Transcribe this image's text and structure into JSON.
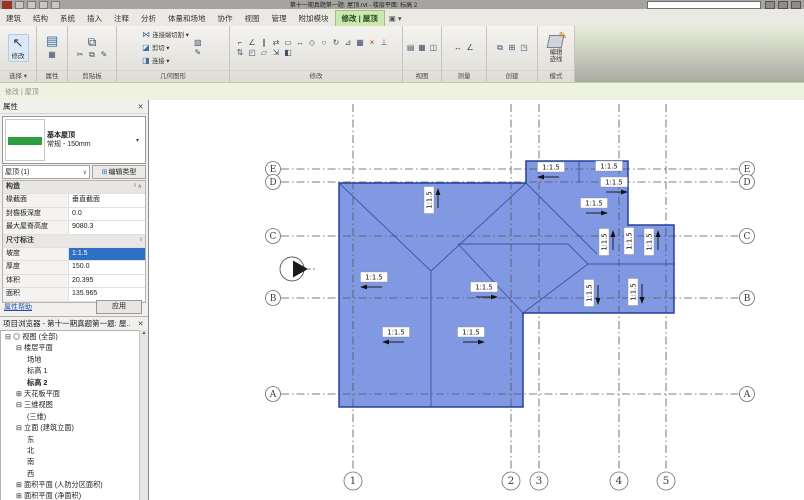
{
  "title_bar": {
    "app_title": "第十一期真题第一题: 屋顶.rvt - 楼层平面: 标高 2"
  },
  "tabs": {
    "items": [
      "建筑",
      "结构",
      "系统",
      "插入",
      "注释",
      "分析",
      "体量和场地",
      "协作",
      "视图",
      "管理",
      "附加模块"
    ],
    "contextual": "修改 | 屋顶",
    "expander": "▣ ▾"
  },
  "ribbon": {
    "modify_button": "修改",
    "select_label": "选择 ▾",
    "properties_label": "属性",
    "clipboard_label": "剪贴板",
    "geometry_label": "几何图形",
    "geometry_items": [
      "连接端切割 ▾",
      "剪切 ▾",
      "连接 ▾"
    ],
    "geometry_icons": [
      "⋈",
      "◪",
      "◨"
    ],
    "modify_panel_label": "修改",
    "modify_icons": [
      "⌐",
      "∠",
      "∥",
      "⇄",
      "▭",
      "↔",
      "◇",
      "○",
      "↻",
      "⊿",
      "▦",
      "×",
      "⊥",
      "⇅",
      "◰",
      "▱",
      "⇲",
      "◧"
    ],
    "view_label": "视图",
    "view_icons": [
      "▤",
      "▦",
      "◫"
    ],
    "measure_label": "测量",
    "measure_icons": [
      "↔",
      "∠"
    ],
    "create_label": "创建",
    "create_icons": [
      "⧉",
      "⊞",
      "◳"
    ],
    "mode_label": "模式",
    "edit_footprint_line1": "编辑",
    "edit_footprint_line2": "迹线",
    "cursor_icon": "↖",
    "palette_icon": "▤",
    "paste_icon": "⧉",
    "clipboard_icons": [
      "✂",
      "⧉",
      "✎"
    ]
  },
  "options_bar": {
    "label": "修改 | 屋顶"
  },
  "properties": {
    "title": "属性",
    "close": "✕",
    "type_name": "基本屋顶",
    "type_desc": "常规 - 150mm",
    "type_arrow": "▾",
    "filter": "屋顶 (1)",
    "filter_arrow": "∨",
    "edit_type": "编辑类型",
    "edit_type_icon": "⊞",
    "sections": [
      {
        "header": "构造",
        "mark": "² ∧",
        "rows": [
          [
            "椽截面",
            "垂直截面"
          ],
          [
            "封檐板深度",
            "0.0"
          ],
          [
            "最大屋脊高度",
            "9080.3"
          ]
        ]
      },
      {
        "header": "尺寸标注",
        "mark": "²",
        "rows": [
          [
            "坡度",
            "1:1.5"
          ],
          [
            "厚度",
            "150.0"
          ],
          [
            "体积",
            "20.395"
          ],
          [
            "面积",
            "135.965"
          ]
        ]
      }
    ],
    "selected": {
      "section": 1,
      "row": 0
    },
    "help": "属性帮助",
    "apply": "应用"
  },
  "browser": {
    "title": "项目浏览器 - 第十一期真题第一题: 屋..",
    "close": "✕",
    "scroll_up": "▲",
    "items": [
      {
        "t": "⊟ ◎ 视图 (全部)",
        "lv": 0
      },
      {
        "t": "⊟ 楼层平面",
        "lv": 1
      },
      {
        "t": "场地",
        "lv": 2
      },
      {
        "t": "标高 1",
        "lv": 2
      },
      {
        "t": "标高 2",
        "lv": 2,
        "bold": true
      },
      {
        "t": "⊞ 天花板平面",
        "lv": 1
      },
      {
        "t": "⊟ 三维视图",
        "lv": 1
      },
      {
        "t": "(三维)",
        "lv": 2
      },
      {
        "t": "⊟ 立面 (建筑立面)",
        "lv": 1
      },
      {
        "t": "东",
        "lv": 2
      },
      {
        "t": "北",
        "lv": 2
      },
      {
        "t": "南",
        "lv": 2
      },
      {
        "t": "西",
        "lv": 2
      },
      {
        "t": "⊞ 面积平面 (人防分区面积)",
        "lv": 1
      },
      {
        "t": "⊞ 面积平面 (净面积)",
        "lv": 1
      }
    ]
  },
  "plan": {
    "grid_rows": [
      {
        "label": "E",
        "y": 169
      },
      {
        "label": "D",
        "y": 182
      },
      {
        "label": "C",
        "y": 236
      },
      {
        "label": "B",
        "y": 298
      },
      {
        "label": "A",
        "y": 394
      }
    ],
    "grid_cols": [
      {
        "label": "1",
        "x": 352
      },
      {
        "label": "2",
        "x": 510
      },
      {
        "label": "3",
        "x": 538
      },
      {
        "label": "4",
        "x": 618
      },
      {
        "label": "5",
        "x": 665
      }
    ],
    "row_bubble": {
      "left_cx": 272,
      "right_cx": 746,
      "r": 7.5,
      "line_x1": 280,
      "line_x2": 738
    },
    "col_bubble": {
      "cy": 481,
      "r": 9,
      "line_y1": 104,
      "line_y2": 470
    },
    "roof_outline": [
      [
        338,
        183
      ],
      [
        525,
        183
      ],
      [
        525,
        161
      ],
      [
        627,
        161
      ],
      [
        627,
        225
      ],
      [
        673,
        225
      ],
      [
        673,
        313
      ],
      [
        522,
        313
      ],
      [
        522,
        407
      ],
      [
        338,
        407
      ]
    ],
    "roof_lines": [
      [
        338,
        183,
        430,
        271
      ],
      [
        430,
        271,
        430,
        407
      ],
      [
        430,
        271,
        525,
        183
      ],
      [
        525,
        183,
        596,
        254
      ],
      [
        457,
        244,
        567,
        244
      ],
      [
        567,
        244,
        587,
        264
      ],
      [
        587,
        264,
        673,
        264
      ],
      [
        457,
        244,
        522,
        313
      ],
      [
        522,
        313,
        587,
        264
      ],
      [
        578,
        161,
        578,
        183
      ]
    ],
    "slope_labels": [
      {
        "x": 550,
        "y": 167,
        "rot": 0,
        "arrow": "left",
        "text": "1:1.5"
      },
      {
        "x": 608,
        "y": 166,
        "rot": 0,
        "arrow": "none",
        "text": "1:1.5"
      },
      {
        "x": 613,
        "y": 182,
        "rot": 0,
        "arrow": "right",
        "text": "1:1.5"
      },
      {
        "x": 593,
        "y": 203,
        "rot": 0,
        "arrow": "right",
        "text": "1:1.5"
      },
      {
        "x": 428,
        "y": 200,
        "rot": 90,
        "arrow": "up",
        "text": "1:1.5"
      },
      {
        "x": 373,
        "y": 277,
        "rot": 0,
        "arrow": "left",
        "text": "1:1.5"
      },
      {
        "x": 483,
        "y": 287,
        "rot": 0,
        "arrow": "right",
        "text": "1:1.5"
      },
      {
        "x": 395,
        "y": 332,
        "rot": 0,
        "arrow": "left",
        "text": "1:1.5"
      },
      {
        "x": 470,
        "y": 332,
        "rot": 0,
        "arrow": "right",
        "text": "1:1.5"
      },
      {
        "x": 603,
        "y": 242,
        "rot": 90,
        "arrow": "up",
        "text": "1:1.5"
      },
      {
        "x": 628,
        "y": 241,
        "rot": 90,
        "arrow": "none",
        "text": "1:1.5"
      },
      {
        "x": 648,
        "y": 242,
        "rot": 90,
        "arrow": "up",
        "text": "1:1.5"
      },
      {
        "x": 588,
        "y": 293,
        "rot": 90,
        "arrow": "down",
        "text": "1:1.5"
      },
      {
        "x": 632,
        "y": 292,
        "rot": 90,
        "arrow": "down",
        "text": "1:1.5"
      }
    ],
    "elevation_marker": {
      "cx": 291,
      "cy": 269,
      "r": 12
    }
  },
  "colors": {
    "roof_fill": "#7D95E2",
    "roof_edge": "#27409B",
    "roof_line": "#3A55A8",
    "grid": "#55545E",
    "annotation": "#111111",
    "selection_red": "#E03226",
    "selection_blue": "#2F6FC4",
    "tab_green": "#CDE7AE"
  }
}
